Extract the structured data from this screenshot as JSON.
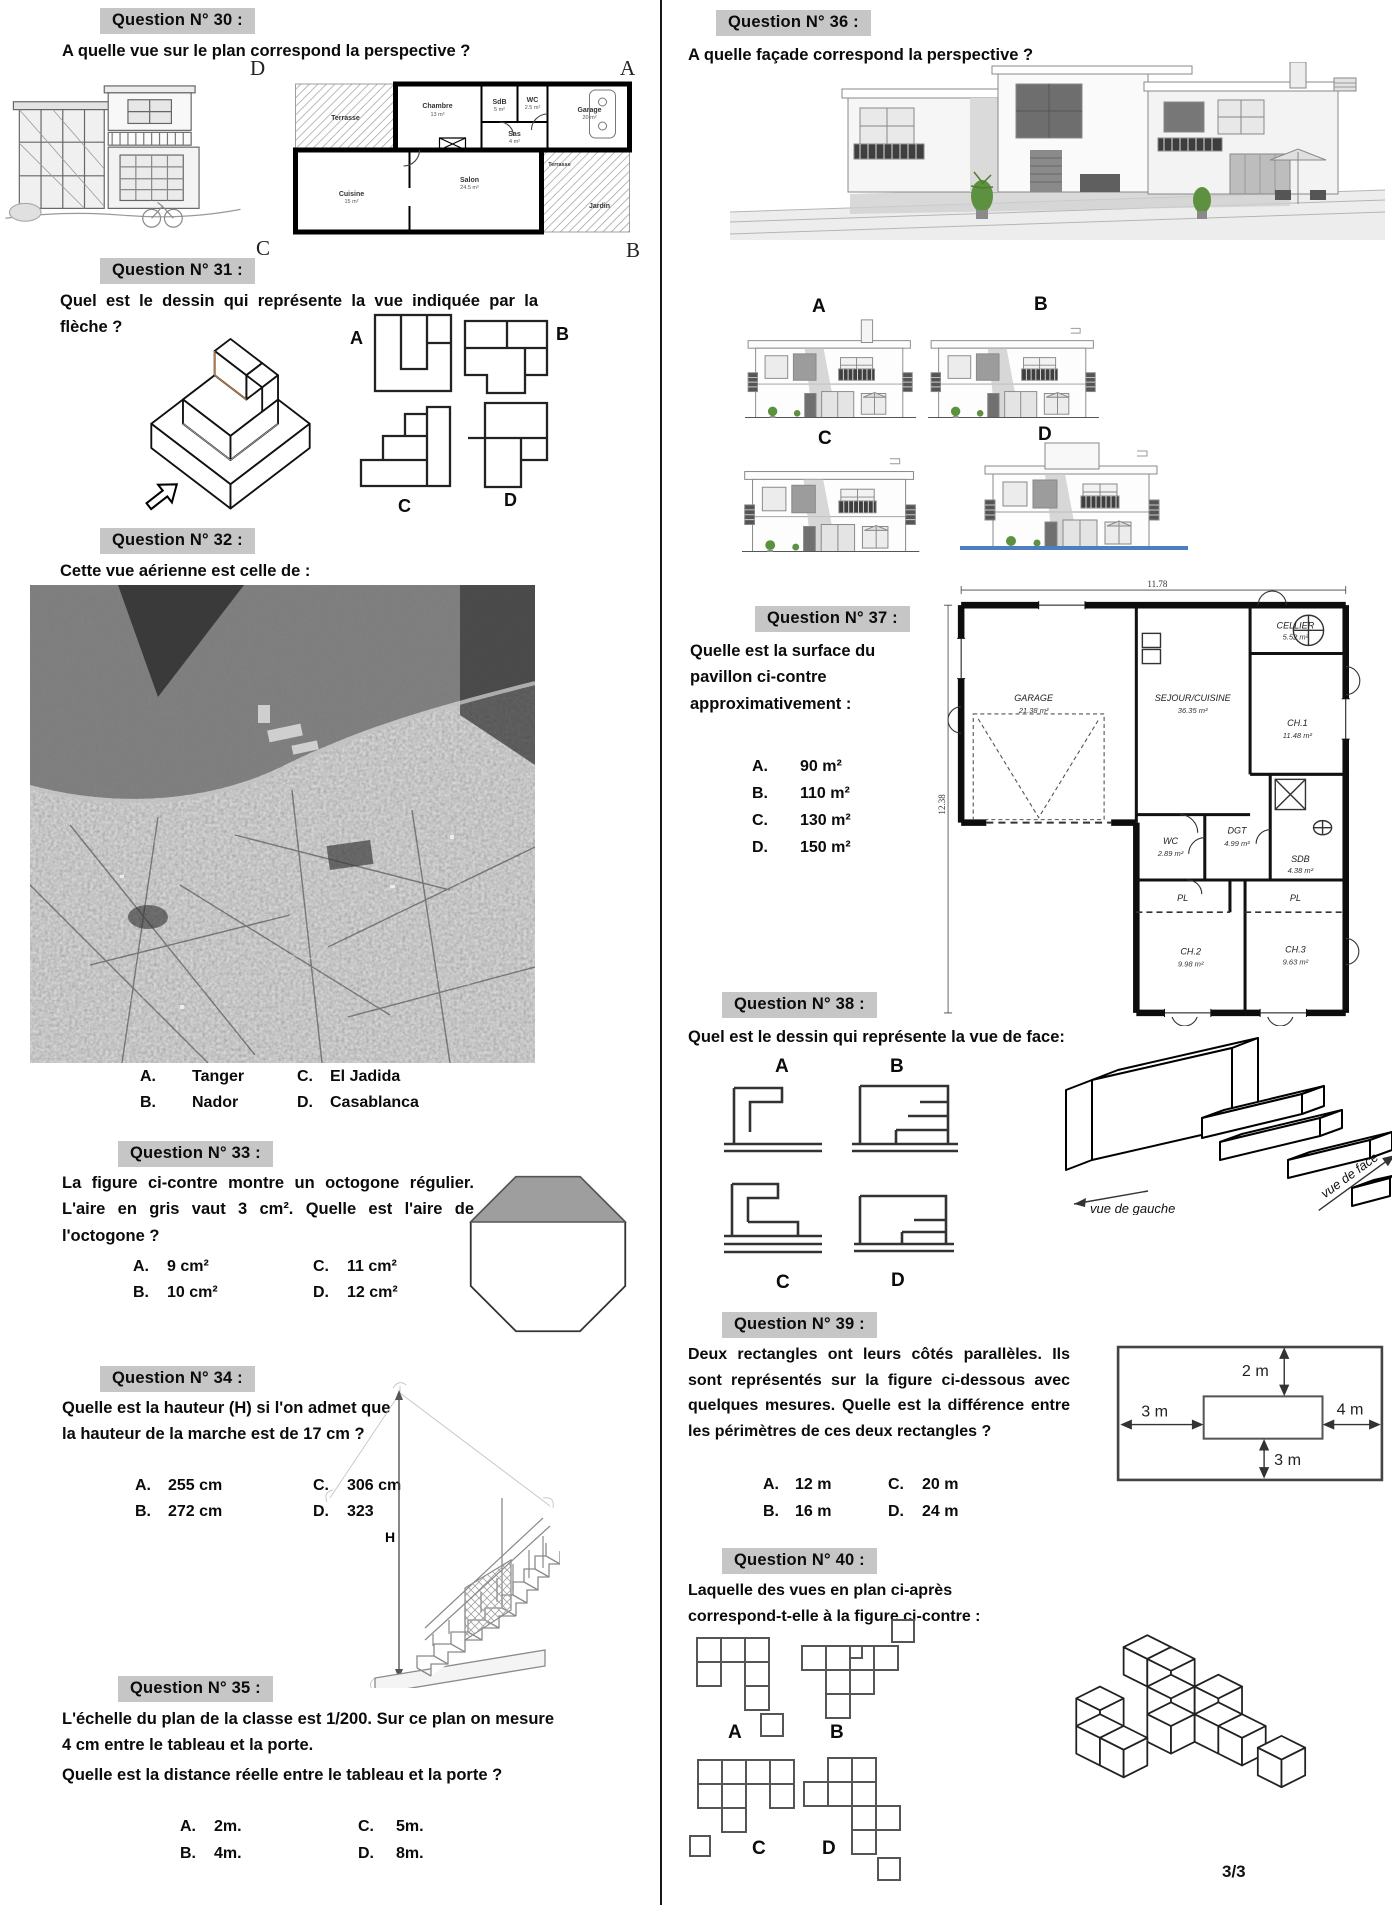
{
  "page": {
    "number": "3/3"
  },
  "q30": {
    "header": "Question N° 30 :",
    "question": "A quelle vue sur le plan correspond la perspective ?",
    "corners": {
      "top_left": "D",
      "top_right": "A",
      "bottom_left": "C",
      "bottom_right": "B"
    },
    "plan": {
      "rooms": [
        {
          "name": "Terrasse",
          "area": ""
        },
        {
          "name": "Chambre",
          "area": "13 m²"
        },
        {
          "name": "SdB",
          "area": "5 m²"
        },
        {
          "name": "WC",
          "area": "2.5 m²"
        },
        {
          "name": "Sas",
          "area": "4 m²"
        },
        {
          "name": "Garage",
          "area": "20 m²"
        },
        {
          "name": "Cuisine",
          "area": "15 m²"
        },
        {
          "name": "Salon",
          "area": "24.5 m²"
        },
        {
          "name": "Terrasse",
          "area": ""
        },
        {
          "name": "Jardin",
          "area": ""
        }
      ]
    }
  },
  "q31": {
    "header": "Question N° 31 :",
    "question": "Quel est le dessin qui représente la vue indiquée par la flèche ?",
    "choices": [
      "A",
      "B",
      "C",
      "D"
    ]
  },
  "q32": {
    "header": "Question N° 32 :",
    "question": "Cette vue aérienne est celle de :",
    "options": [
      {
        "letter": "A.",
        "text": "Tanger"
      },
      {
        "letter": "B.",
        "text": "Nador"
      },
      {
        "letter": "C.",
        "text": "El Jadida"
      },
      {
        "letter": "D.",
        "text": "Casablanca"
      }
    ]
  },
  "q33": {
    "header": "Question N° 33 :",
    "question": "La figure ci-contre montre un octogone régulier. L'aire en gris vaut 3 cm². Quelle est l'aire de l'octogone ?",
    "options": [
      {
        "letter": "A.",
        "text": "9 cm²"
      },
      {
        "letter": "B.",
        "text": "10 cm²"
      },
      {
        "letter": "C.",
        "text": "11 cm²"
      },
      {
        "letter": "D.",
        "text": "12 cm²"
      }
    ]
  },
  "q34": {
    "header": "Question N° 34 :",
    "question": "Quelle est la hauteur (H) si l'on admet que la hauteur de la marche est de 17 cm ?",
    "h_label": "H",
    "options": [
      {
        "letter": "A.",
        "text": "255 cm"
      },
      {
        "letter": "B.",
        "text": "272 cm"
      },
      {
        "letter": "C.",
        "text": "306 cm"
      },
      {
        "letter": "D.",
        "text": "323"
      }
    ]
  },
  "q35": {
    "header": "Question N° 35 :",
    "line1": "L'échelle du plan de la classe est 1/200. Sur ce plan on mesure 4 cm entre le tableau et la porte.",
    "line2": "Quelle est la distance réelle entre le tableau et la porte ?",
    "options": [
      {
        "letter": "A.",
        "text": "2m."
      },
      {
        "letter": "B.",
        "text": "4m."
      },
      {
        "letter": "C.",
        "text": "5m."
      },
      {
        "letter": "D.",
        "text": "8m."
      }
    ]
  },
  "q36": {
    "header": "Question N° 36 :",
    "question": "A quelle façade correspond la perspective ?",
    "choices": [
      "A",
      "B",
      "C",
      "D"
    ]
  },
  "q37": {
    "header": "Question N° 37 :",
    "question": "Quelle est la surface du pavillon ci-contre approximativement :",
    "options": [
      {
        "letter": "A.",
        "text": "90 m²"
      },
      {
        "letter": "B.",
        "text": "110 m²"
      },
      {
        "letter": "C.",
        "text": "130 m²"
      },
      {
        "letter": "D.",
        "text": "150 m²"
      }
    ],
    "plan": {
      "dim_top": "11.78",
      "dim_left": "12.38",
      "rooms": [
        {
          "name": "GARAGE",
          "area": "21.38 m²"
        },
        {
          "name": "SEJOUR/CUISINE",
          "area": "36.35 m²"
        },
        {
          "name": "CELLIER",
          "area": "5.52 m²"
        },
        {
          "name": "CH.1",
          "area": "11.48 m²"
        },
        {
          "name": "SDB",
          "area": "4.38 m²"
        },
        {
          "name": "WC",
          "area": "2.89 m²"
        },
        {
          "name": "DGT",
          "area": "4.99 m²"
        },
        {
          "name": "PL",
          "area": ""
        },
        {
          "name": "PL",
          "area": ""
        },
        {
          "name": "CH.2",
          "area": "9.98 m²"
        },
        {
          "name": "CH.3",
          "area": "9.63 m²"
        }
      ]
    }
  },
  "q38": {
    "header": "Question N° 38 :",
    "question": "Quel est le dessin qui représente la vue de face:",
    "choices": [
      "A",
      "B",
      "C",
      "D"
    ],
    "annotations": {
      "left": "vue de gauche",
      "front": "vue de face"
    }
  },
  "q39": {
    "header": "Question N° 39 :",
    "question": "Deux rectangles ont leurs côtés parallèles. Ils sont représentés sur la figure ci-dessous avec quelques mesures. Quelle est la différence entre les périmètres de ces deux rectangles ?",
    "options": [
      {
        "letter": "A.",
        "text": "12 m"
      },
      {
        "letter": "B.",
        "text": "16 m"
      },
      {
        "letter": "C.",
        "text": "20 m"
      },
      {
        "letter": "D.",
        "text": "24 m"
      }
    ],
    "dims": {
      "top": "2 m",
      "left": "3 m",
      "right": "4 m",
      "bottom": "3 m"
    }
  },
  "q40": {
    "header": "Question N° 40 :",
    "question": "Laquelle des vues en plan ci-après correspond-t-elle à la figure ci-contre :",
    "choices": [
      "A",
      "B",
      "C",
      "D"
    ]
  }
}
